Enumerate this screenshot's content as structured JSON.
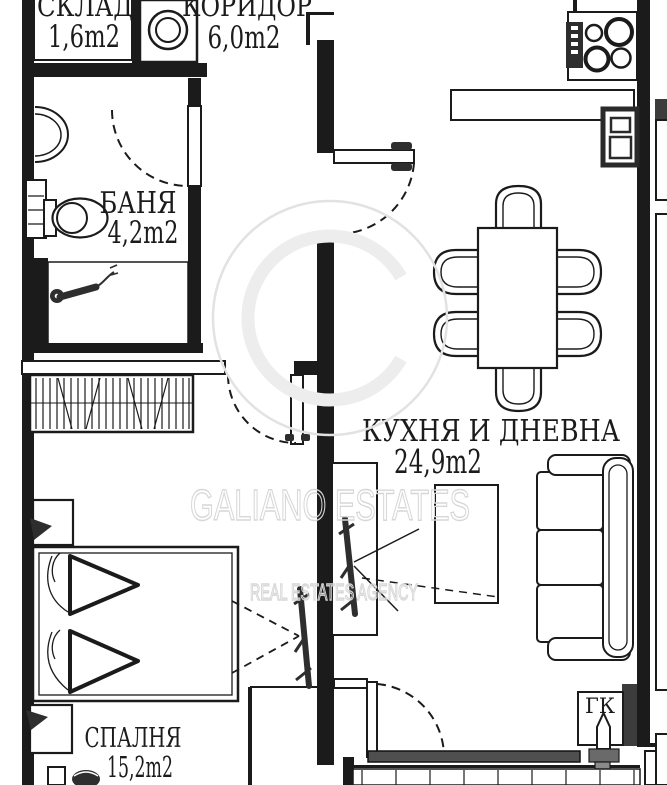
{
  "rooms": {
    "storage": {
      "name": "СКЛАД",
      "area": "1,6m2"
    },
    "corridor": {
      "name": "КОРИДОР",
      "area": "6,0m2"
    },
    "bathroom": {
      "name": "БАНЯ",
      "area": "4,2m2"
    },
    "kitchen_living": {
      "name": "КУХНЯ И ДНЕВНА",
      "area": "24,9m2"
    },
    "bedroom": {
      "name": "СПАЛНЯ",
      "area": "15,2m2"
    }
  },
  "labels": {
    "utility_shaft": "ГК"
  },
  "watermark": {
    "brand": "GALIANO ESTATES",
    "tagline": "REAL ESTATES AGENCY"
  },
  "colors": {
    "line": "#1b1b1b",
    "dark_fixture": "#2e2e2e",
    "window_glass": "#4f4f4f",
    "watermark": "#d7d7d7",
    "background": "#ffffff"
  }
}
